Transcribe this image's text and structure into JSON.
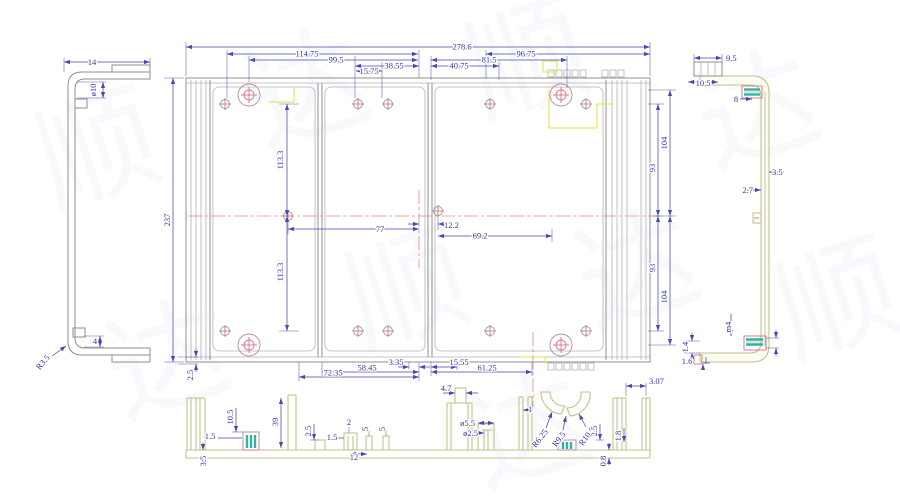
{
  "drawing": {
    "kind": "2D CAD multi-view technical drawing of an aluminum enclosure"
  },
  "colors": {
    "dimension_blue": "#4949ae",
    "geometry_gray": "#8f8f8f",
    "profile_olive": "#c2c28c",
    "accent_pink": "#d4758a",
    "centerline_pink": "#e08a8a",
    "thread_teal": "#2fb3a3",
    "highlight_yellow": "#ebe75e",
    "background": "#ffffff"
  },
  "watermark": {
    "chars": [
      "顺",
      "达"
    ]
  },
  "plan": {
    "top": [
      "278.6",
      "114.75",
      "99.5",
      "38.55",
      "15.75",
      "40.75",
      "81.5",
      "96.75"
    ],
    "left": [
      "237",
      "113.3",
      "113.3",
      "2.5"
    ],
    "right": [
      "104",
      "93",
      "93",
      "104"
    ],
    "center": [
      "77",
      "12.2",
      "69.2"
    ],
    "bottom": [
      "72.35",
      "58.45",
      "3.35",
      "15.55",
      "61.25"
    ]
  },
  "left_view": {
    "dims": [
      "14",
      "ø10",
      "4",
      "R3.5"
    ]
  },
  "right_view": {
    "dims": [
      "9.5",
      "10.5",
      "8",
      "3.5",
      "2.7",
      "m4",
      "1.4",
      "1.6"
    ]
  },
  "section": {
    "dims": [
      "1.5",
      "3.5",
      "10.5",
      "39",
      "2.5",
      "1.5",
      "2",
      "5",
      "5",
      "12",
      "4.7",
      "ø5.5",
      "ø2.5",
      "1",
      "R6.25",
      "R9.5",
      "R10.5",
      "2.5",
      "1.8",
      "0.8",
      "3.07"
    ]
  }
}
